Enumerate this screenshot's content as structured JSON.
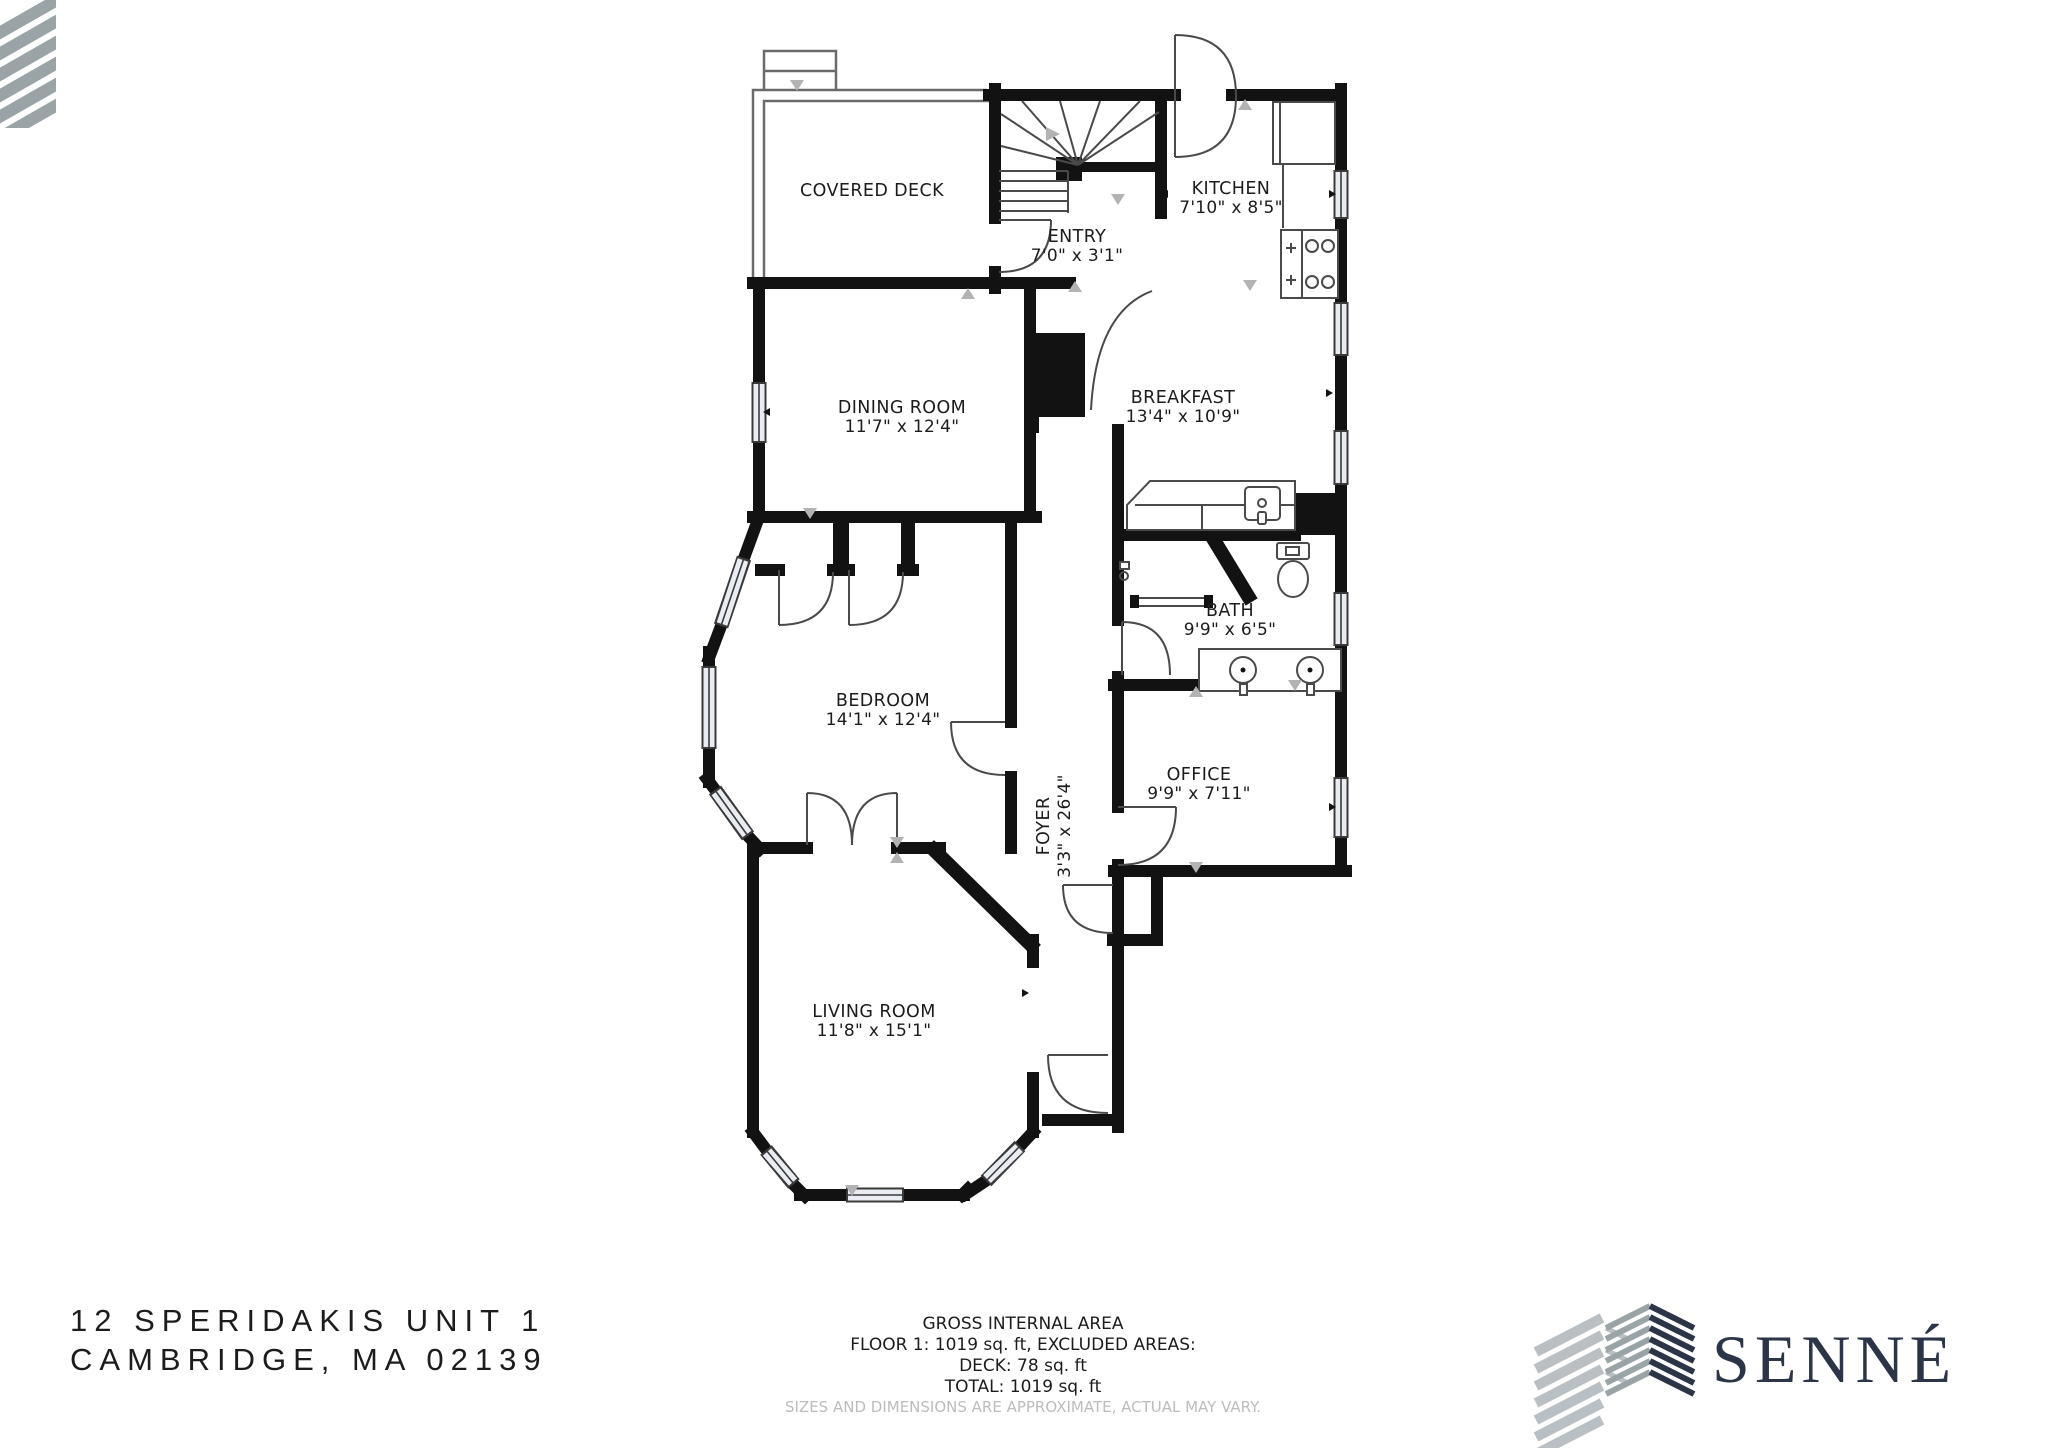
{
  "floorplan": {
    "rooms": [
      {
        "name": "COVERED DECK",
        "dims": ""
      },
      {
        "name": "ENTRY",
        "dims": "7'0\" x 3'1\""
      },
      {
        "name": "KITCHEN",
        "dims": "7'10\" x 8'5\""
      },
      {
        "name": "DINING ROOM",
        "dims": "11'7\" x 12'4\""
      },
      {
        "name": "BREAKFAST",
        "dims": "13'4\" x 10'9\""
      },
      {
        "name": "BATH",
        "dims": "9'9\" x 6'5\""
      },
      {
        "name": "BEDROOM",
        "dims": "14'1\" x 12'4\""
      },
      {
        "name": "OFFICE",
        "dims": "9'9\" x 7'11\""
      },
      {
        "name": "FOYER",
        "dims": "3'3\" x 26'4\""
      },
      {
        "name": "LIVING ROOM",
        "dims": "11'8\" x 15'1\""
      }
    ]
  },
  "footer": {
    "address_line1": "12 SPERIDAKIS UNIT 1",
    "address_line2": "CAMBRIDGE, MA 02139",
    "area_title": "GROSS INTERNAL AREA",
    "area_line1": "FLOOR 1: 1019 sq. ft, EXCLUDED AREAS:",
    "area_line2": "DECK: 78 sq. ft",
    "area_line3": "TOTAL: 1019 sq. ft",
    "disclaimer": "SIZES AND DIMENSIONS ARE APPROXIMATE, ACTUAL MAY VARY.",
    "brand": "SENNÉ"
  },
  "colors": {
    "wall": "#121212",
    "line": "#4a4a4a",
    "window_fill": "#e9edf3",
    "marker_gray": "#b3b3b3",
    "brand_navy": "#2c3547",
    "brand_gray": "#9aa3a6",
    "disclaimer_gray": "#bcbcbc"
  }
}
